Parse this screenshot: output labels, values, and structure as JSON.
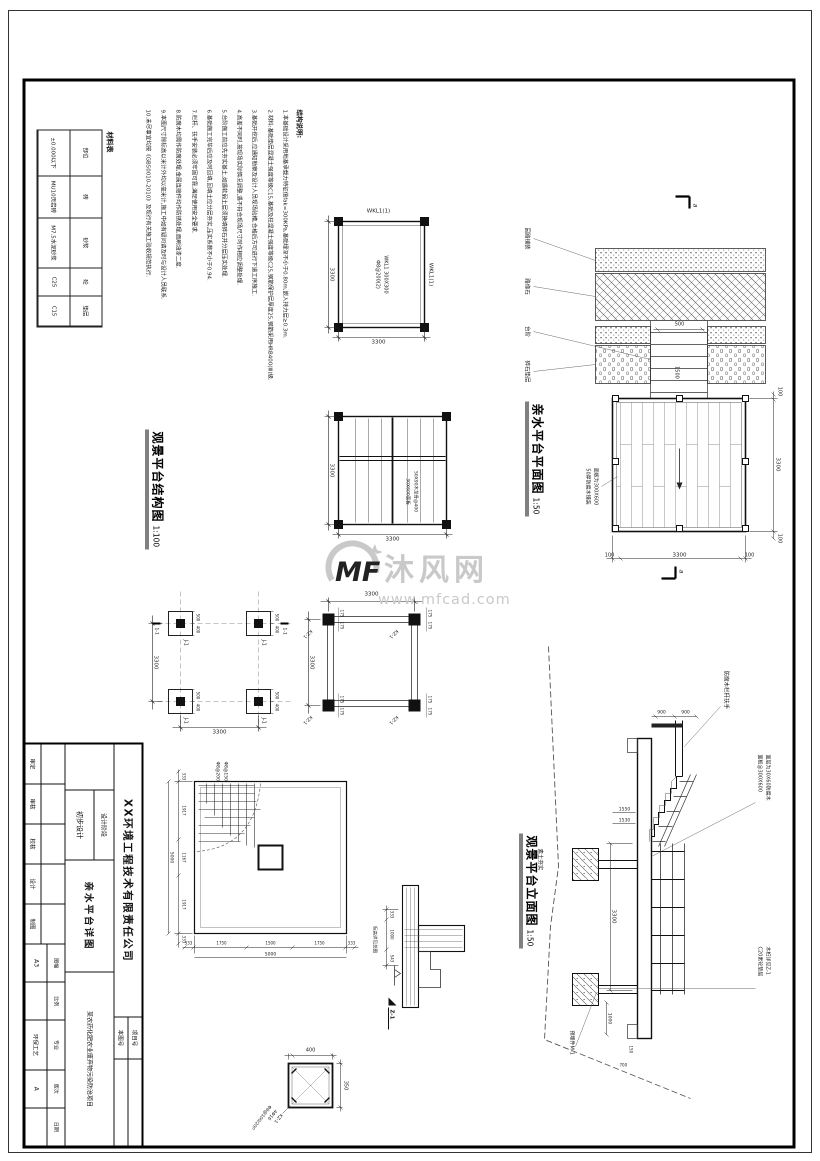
{
  "watermark": {
    "logo": "MF",
    "brand": "沐风网",
    "site": "www.mfcad.com"
  },
  "notes": {
    "title": "结构说明:",
    "lines": [
      "1.本基础设计采用地基承载力特征值fak=300KPa,基础埋深不小于0.80m,嵌入持力层≥0.3m.",
      "2.材料:基础垫层混凝土强度等级C15,基础及柱混凝土强度等级C25,钢筋保护层厚度25,钢筋采用HRB400(Ⅲ)级.",
      "3.基础开挖后,应通知勘察及设计人员现场验槽,合格后方可进行下道工序施工.",
      "4.高差不同时,按现场实际情况调整,遇不符合现场尺寸时作相应调整处理.",
      "5.台阶施工前应先夯实基土,如遇软弱土层须换填碎石并分层压实处理.",
      "6.基础施工完毕后应及时回填,回填土应分层夯实,压实系数不小于0.94.",
      "7.栏杆、扶手安装必须牢固可靠,满足使用安全要求.",
      "8.防腐木均需作防腐处理,金属连接件均作防锈处理,面刷油漆二度.",
      "9.本图尺寸除标高以米计外均以毫米计,施工中如有疑问请及时与设计人员联系.",
      "10.未尽事宜均按《GB50010-2010》及现行有关施工验收规范执行."
    ]
  },
  "material_table": {
    "title": "材料表",
    "headers": [
      "部位",
      "砖",
      "砂浆",
      "砼",
      "垫层"
    ],
    "row": [
      "±0.000以下",
      "MU10页岩砖",
      "M7.5水泥砂浆",
      "C25",
      "C15"
    ]
  },
  "frame_plan": {
    "beam_label": "WKL1(1)",
    "note1": "WKL1 300X300",
    "note2": "Φ8@200(2)",
    "dim_w": "3300",
    "dim_h": "3300"
  },
  "deck_plan": {
    "note1": "50X90木龙骨@400",
    "note2": "30X600面板",
    "dim_w": "3300",
    "dim_h": "3300"
  },
  "struct_title": {
    "text": "观景平台结构图",
    "scale": "1:100"
  },
  "footing_plan": {
    "label": "J-1",
    "dim_a": "500",
    "dim_b": "400",
    "dim_w": "3300",
    "dim_h": "3300",
    "section": "1-1"
  },
  "column_plan": {
    "label": "KZ-1",
    "dim_a": "175",
    "dim_b": "175",
    "dim_w": "3300",
    "dim_h": "3300"
  },
  "water_plan": {
    "title": "亲水平台平面图",
    "scale": "1:50",
    "dims": {
      "top1": "100",
      "top2": "3300",
      "top3": "100",
      "right1": "100",
      "right2": "3300",
      "right3": "100",
      "step_w": "500",
      "step_d": "1500"
    },
    "labels": [
      "园路铺装",
      "路缘石",
      "台阶",
      "碎石垫层"
    ],
    "deck_note1": "面板为300X600",
    "deck_note2": "50厚防腐木铺装",
    "section_letter": "a"
  },
  "elevation": {
    "title": "观景平台立面图",
    "scale": "1:50",
    "notes": {
      "railing": "防腐木栏杆扶手",
      "deck1": "面层为30X60防腐木",
      "deck2": "面板@300X600",
      "pile1": "木桩详见Z-1",
      "pile2": "C20素砼垫层",
      "ground": "素土夯实",
      "embed": "预埋件M-1"
    },
    "dims": {
      "rail1": "900",
      "rail2": "900",
      "h1": "1550",
      "h2": "1530",
      "span": "3300",
      "end": "1000",
      "d150": "150",
      "d700": "700"
    }
  },
  "j1_detail": {
    "bottom": [
      "333",
      "1917",
      "1167",
      "1917",
      "333"
    ],
    "right": [
      "333",
      "1750",
      "1500",
      "1750",
      "333"
    ],
    "total": "5000",
    "rebar1": "Φ8@150",
    "rebar2": "Φ8@200"
  },
  "section_detail": {
    "dims": [
      "333",
      "1000",
      "543"
    ],
    "marker": "Z-1",
    "note": "标高详见总图"
  },
  "kz1_detail": {
    "dim_w": "350",
    "dim_h": "400",
    "label": "KZ-1",
    "bars": "4Φ16",
    "stirrup": "Φ8@100/200"
  },
  "title_block": {
    "company": "XX环境工程技术有限责任公司",
    "project_no_label": "项目号",
    "sheet_no_label": "本图号",
    "stage_label": "设计阶段",
    "stage": "初步设计",
    "drawing_title": "亲水平台详图",
    "project_name": "某农药化肥农业废弃物污染防治项目",
    "sign_labels": [
      "审定",
      "审核",
      "校核",
      "设计",
      "制图"
    ],
    "meta": [
      {
        "label": "图幅",
        "value": "A3"
      },
      {
        "label": "比例",
        "value": ""
      },
      {
        "label": "专业",
        "value": "环保工艺"
      },
      {
        "label": "版次",
        "value": "A"
      },
      {
        "label": "日期",
        "value": ""
      }
    ]
  }
}
